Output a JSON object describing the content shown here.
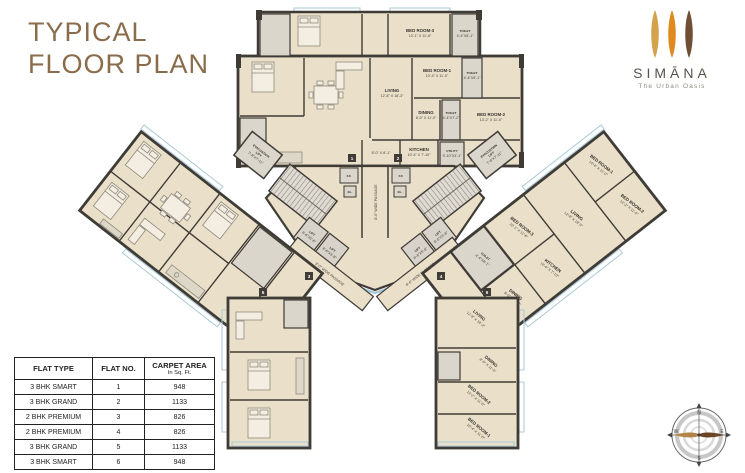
{
  "header": {
    "title_line1": "TYPICAL",
    "title_line2": "FLOOR PLAN"
  },
  "logo": {
    "brand": "SIMĀNA",
    "tagline": "The Urban Oasis",
    "petal_colors": [
      "#D4A14C",
      "#DE8A1E",
      "#6F4E33"
    ]
  },
  "table": {
    "col1": "FLAT TYPE",
    "col2": "FLAT NO.",
    "col3": "CARPET AREA",
    "col3_sub": "In Sq. Ft.",
    "rows": [
      {
        "type": "3 BHK SMART",
        "no": "1",
        "area": "948"
      },
      {
        "type": "3 BHK GRAND",
        "no": "2",
        "area": "1133"
      },
      {
        "type": "2 BHK PREMIUM",
        "no": "3",
        "area": "826"
      },
      {
        "type": "2 BHK PREMIUM",
        "no": "4",
        "area": "826"
      },
      {
        "type": "3 BHK GRAND",
        "no": "5",
        "area": "1133"
      },
      {
        "type": "3 BHK SMART",
        "no": "6",
        "area": "948"
      }
    ]
  },
  "compass": {
    "north": "N",
    "south": "S",
    "east": "E",
    "west": "W"
  },
  "plan": {
    "rooms": {
      "living": {
        "name": "LIVING",
        "dim": "12'-8\" X 18'-3\""
      },
      "dining": {
        "name": "DINING",
        "dim": "8'-0\" X 11'-0\""
      },
      "kitchen": {
        "name": "KITCHEN",
        "dim": "10'-4\" X 7'-10\""
      },
      "utility": {
        "name": "UTILITY",
        "dim": "5'-10\"X3'-1\""
      },
      "bedroom1": {
        "name": "BED ROOM-1",
        "dim": "10'-4\" X 11'-0\""
      },
      "bedroom2": {
        "name": "BED ROOM-2",
        "dim": "13'-2\" X 11'-0\""
      },
      "bedroom3": {
        "name": "BED ROOM-3",
        "dim": "10'-1\" X 11'-6\""
      },
      "toilet": {
        "name": "TOILET",
        "dim": "4'-4\"X8'-1\""
      },
      "toilet2": {
        "name": "TOILET",
        "dim": "4'-4\"X7'-2\""
      }
    },
    "core": {
      "ff": "F.F.",
      "el": "EL.",
      "lift_name": "LIFT",
      "lift_dim": "6'-6\"X5'-8\"",
      "passage": "8'-0\" WIDE PASSAGE",
      "evac_line1": "EVACUATION",
      "evac_line2": "LIFT",
      "evac_dim": "7'-8\"X7'-11\"",
      "foyer_dim": "8'-0\" X 8'-1\""
    },
    "flat_tags": [
      "1",
      "2",
      "3",
      "4",
      "5",
      "6"
    ]
  }
}
